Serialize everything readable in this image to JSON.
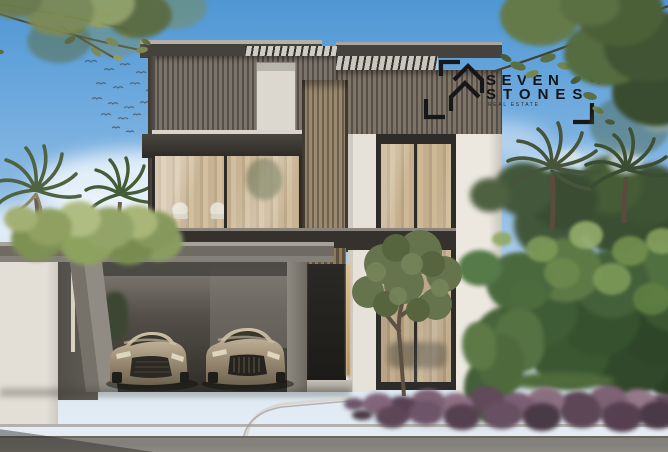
{
  "scene": {
    "type": "architectural-render",
    "subject": "Modern two-storey luxury villa with slatted timber facade, glass balcony lounge, double-height window, carport with two champagne-coloured cars, palm trees and tropical garden",
    "sky": "clear blue sky with soft clouds and a flock of birds"
  },
  "watermark": {
    "brand_line1": "SEVEN",
    "brand_line2": "STONES",
    "tagline": "REAL ESTATE",
    "icon": "house-roof-monogram-with-corner-brackets",
    "color": "#141416"
  },
  "palette": {
    "sky_top": "#4f97d4",
    "sky_horizon": "#e7eef4",
    "facade_slats": "#6a645c",
    "stone_white": "#e9e5dd",
    "concrete": "#8d8981",
    "glass_warm": "#c7b291",
    "carport_shadow": "#2b2924",
    "car_champagne": "#a4957c",
    "foliage_dark": "#3c5531",
    "foliage_light": "#9aa86f",
    "flowerbed_purple": "#7d6174",
    "pavement": "#c6c3bb",
    "road": "#84817a"
  }
}
